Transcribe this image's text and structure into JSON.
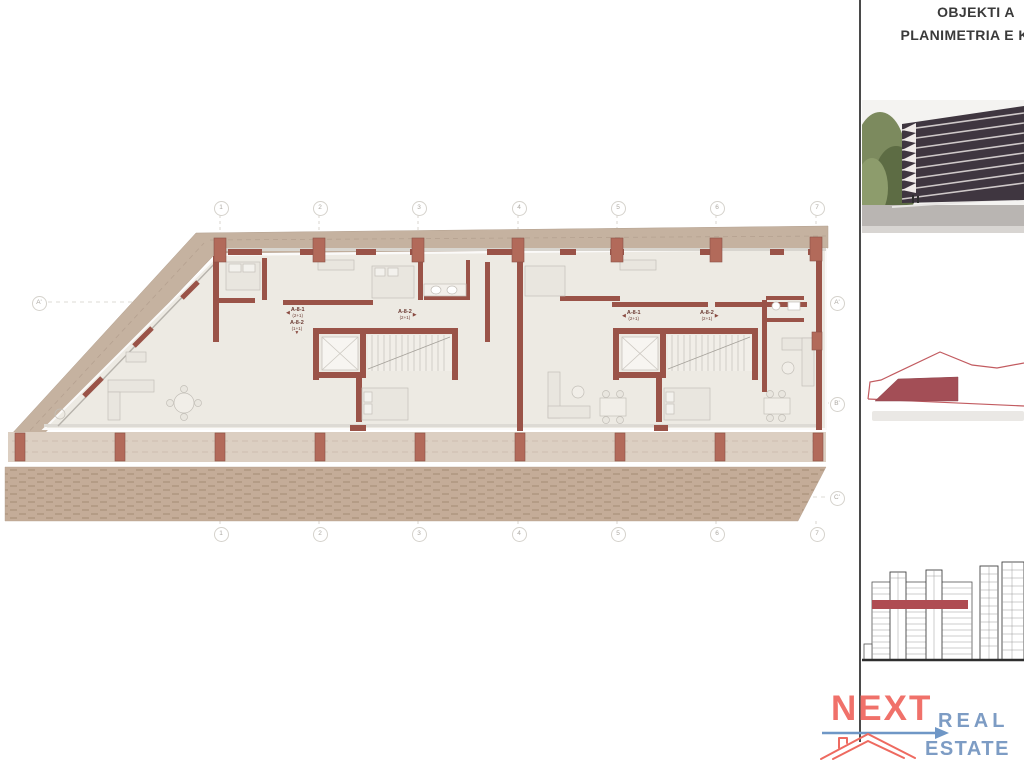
{
  "title_block": {
    "project": "OBJEKTI A",
    "drawing": "PLANIMETRIA E KATI"
  },
  "plan": {
    "grid_columns": [
      "1",
      "2",
      "3",
      "4",
      "5",
      "6",
      "7"
    ],
    "row_left": [
      "A'"
    ],
    "row_right": [
      "A'",
      "B'",
      "C'"
    ],
    "unit_labels": [
      {
        "name": "A-8-1",
        "type": "(2+1)",
        "arrow": "◀"
      },
      {
        "name": "A-8-2",
        "type": "(1+1)",
        "arrow": "▼"
      },
      {
        "name": "A-8-2",
        "type": "(2+1)",
        "arrow": "▶"
      },
      {
        "name": "A-8-1",
        "type": "(2+1)",
        "arrow": "◀"
      },
      {
        "name": "A-8-2",
        "type": "(2+1)",
        "arrow": "▶"
      }
    ]
  },
  "logo": {
    "word1": "NEXT",
    "word2": "REAL",
    "word3": "ESTATE"
  },
  "colors": {
    "wall": "#9A5348",
    "column": "#B26A5A",
    "balcony_band": "#C5B2A0",
    "terrace": "#DCCFC2",
    "paving": "#C4AC98",
    "floor": "#EDEAE3",
    "site_fill": "#A34E56",
    "site_outline": "#C25B60",
    "elevation_band": "#AF4C52",
    "logo_coral": "#F0716A",
    "logo_blue": "#7D9CC4",
    "title_text": "#3A3A3A"
  }
}
